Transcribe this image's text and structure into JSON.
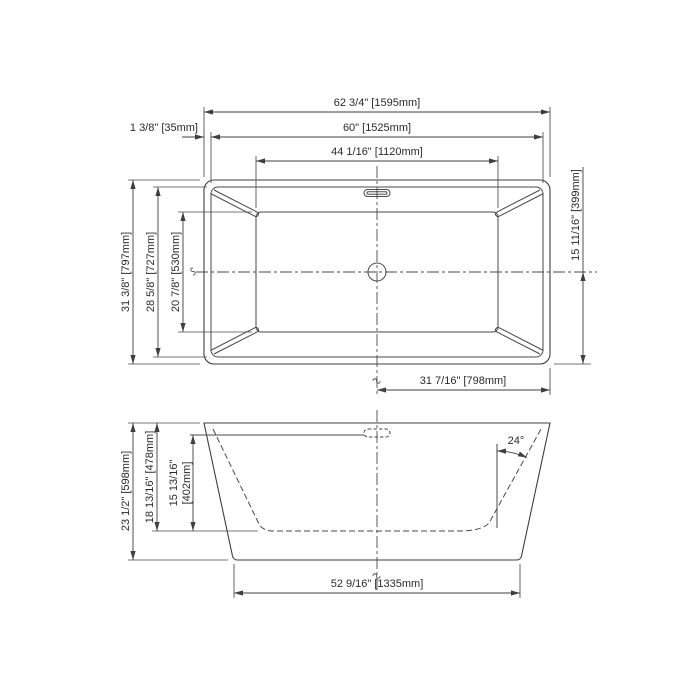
{
  "top_view": {
    "dim_overall_width": "62 3/4\" [1595mm]",
    "dim_rim_offset": "1 3/8\" [35mm]",
    "dim_inner_width": "60\" [1525mm]",
    "dim_basin_width": "44 1/16\" [1120mm]",
    "dim_overall_depth": "31 3/8\" [797mm]",
    "dim_inner_depth": "28 5/8\" [727mm]",
    "dim_basin_depth": "20 7/8\" [530mm]",
    "dim_center_to_end": "15 11/16\" [399mm]",
    "dim_drain_to_end": "31 7/16\" [798mm]"
  },
  "side_view": {
    "dim_overall_height": "23 1/2\" [598mm]",
    "dim_rim_to_basin_floor": "18 13/16\" [478mm]",
    "dim_ledge_to_floor_in": "15 13/16\"",
    "dim_ledge_to_floor_mm": "[402mm]",
    "dim_base_length": "52 9/16\" [1335mm]",
    "dim_wall_angle": "24°"
  },
  "colors": {
    "line": "#3f3f3f",
    "text": "#2b2b2b",
    "background": "#ffffff"
  }
}
